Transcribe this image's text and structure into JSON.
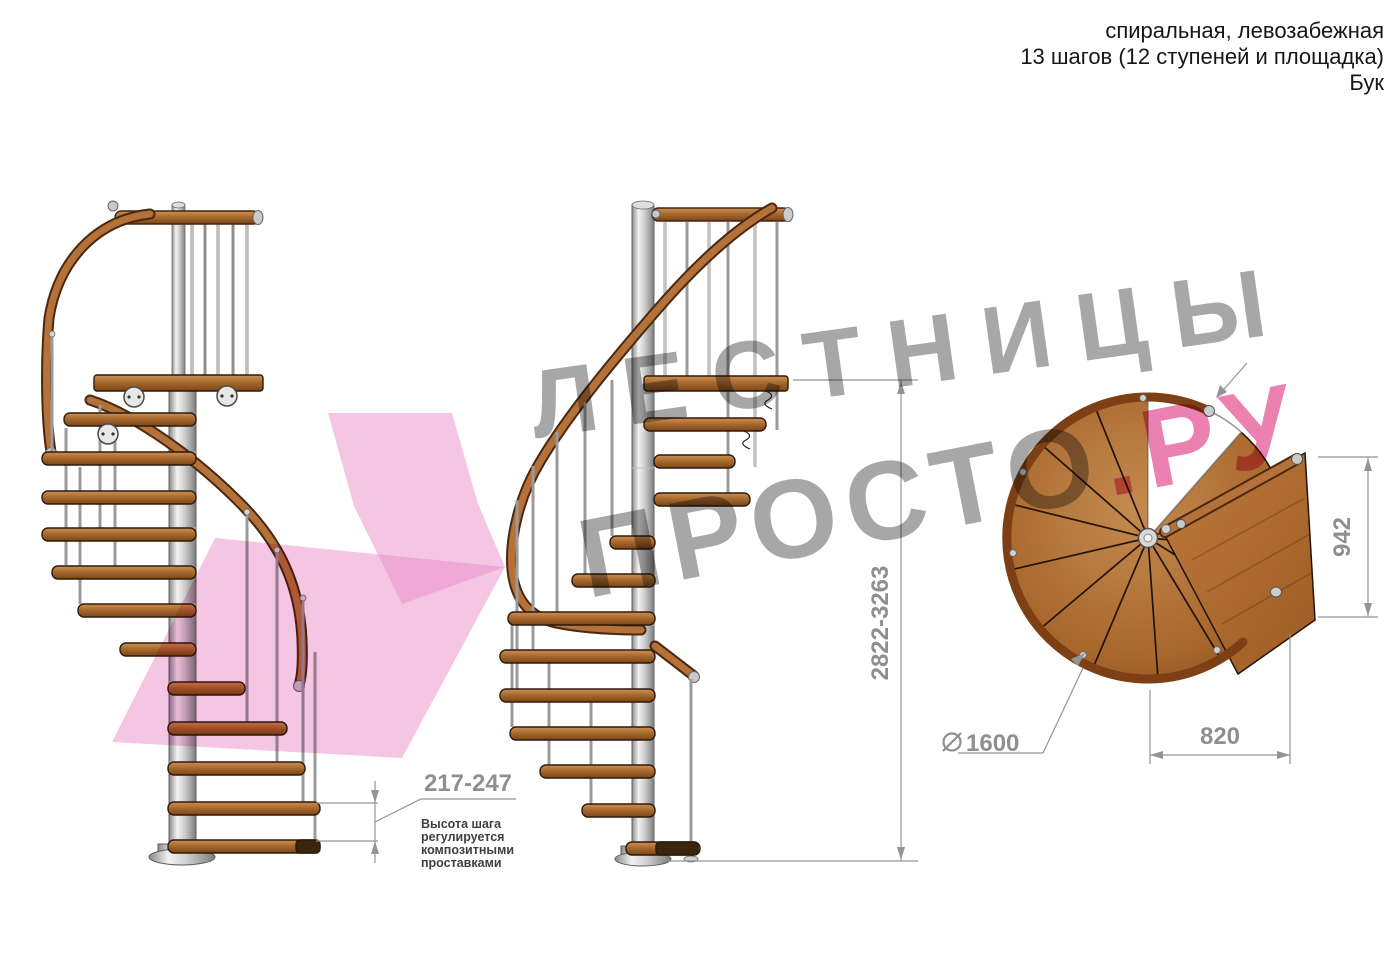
{
  "title": {
    "line1": "спиральная, левозабежная",
    "line2": "13 шагов (12 ступеней и площадка)",
    "line3": "Бук"
  },
  "watermark": {
    "line1": "ЛЕСТНИЦЫ",
    "line2_gray": "ПРОСТО",
    "line2_pink": ".РУ",
    "gray_color": "#7d7d7d",
    "pink_text_color": "#e0458c",
    "arrow_color": "#ec8ec9"
  },
  "dimensions": {
    "total_height": {
      "label": "2822-3263"
    },
    "step_height": {
      "label": "217-247",
      "note_lines": [
        "Высота шага",
        "регулируется",
        "композитными",
        "проставками"
      ]
    },
    "platform_width": {
      "label": "942"
    },
    "platform_depth": {
      "label": "820"
    },
    "diameter": {
      "symbol": "∅",
      "label": "1600"
    }
  },
  "colors": {
    "wood": "#a96a2e",
    "wood_dark": "#4a2810",
    "metal": "#cfcfcf",
    "dim_lines": "#949494"
  }
}
